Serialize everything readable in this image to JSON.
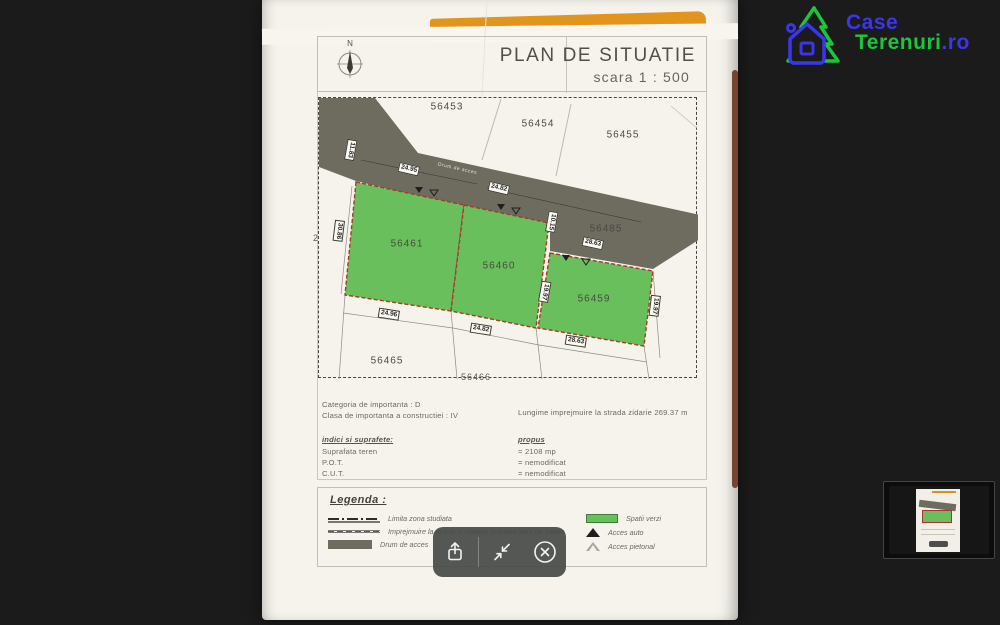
{
  "colors": {
    "background": "#1b1b1b",
    "paper": "#f5f3ec",
    "road_gray": "#6d6c5f",
    "parcel_green": "#69bf5b",
    "fence_red": "#b23a2a",
    "folder_orange": "#e2951d",
    "page_edge_brown": "#6e3a22",
    "logo_blue": "#3a36ee",
    "logo_green": "#1ec43b",
    "toolbar_gray": "#494d49"
  },
  "logo": {
    "word1": "Case",
    "word2": "Terenuri",
    "suffix": ".ro"
  },
  "document": {
    "title": "PLAN DE SITUATIE",
    "scale": "scara 1 : 500",
    "north": "N",
    "map": {
      "road_label": "Drum de acces",
      "parcels": [
        "56453",
        "56454",
        "56455",
        "56485",
        "56461",
        "56460",
        "56459",
        "56465",
        "56466",
        "2"
      ],
      "dims": [
        "24.95",
        "24.82",
        "28.63",
        "11.83",
        "10.15",
        "30.86",
        "19.97",
        "19.97",
        "24.96",
        "24.82",
        "28.63"
      ]
    },
    "info": {
      "category": "Categoria de importanta : D",
      "class": "Clasa de importanta a constructiei : IV",
      "indici_heading": "indici si suprafete:",
      "indici": [
        "Suprafata teren",
        "P.O.T.",
        "C.U.T."
      ],
      "fence_length": "Lungime imprejmuire la strada zidarie  269.37 m",
      "propus_heading": "propus",
      "propus": [
        "= 2108 mp",
        "= nemodificat",
        "= nemodificat"
      ]
    },
    "legend": {
      "heading": "Legenda :",
      "left": [
        {
          "symbol": "dashdot-line",
          "label": "Limita zona studiata"
        },
        {
          "symbol": "red-dashed-line",
          "label": "Imprejmuire la strada si laterala propusa gard de sarma"
        },
        {
          "symbol": "road-swatch",
          "label": "Drum de acces"
        }
      ],
      "right": [
        {
          "symbol": "green-swatch",
          "label": "Spatii verzi"
        },
        {
          "symbol": "filled-triangle",
          "label": "Acces auto"
        },
        {
          "symbol": "outline-triangle",
          "label": "Acces pietonal"
        }
      ]
    }
  },
  "toolbar": {
    "icons": [
      "share-icon",
      "minimize-icon",
      "close-icon"
    ]
  }
}
